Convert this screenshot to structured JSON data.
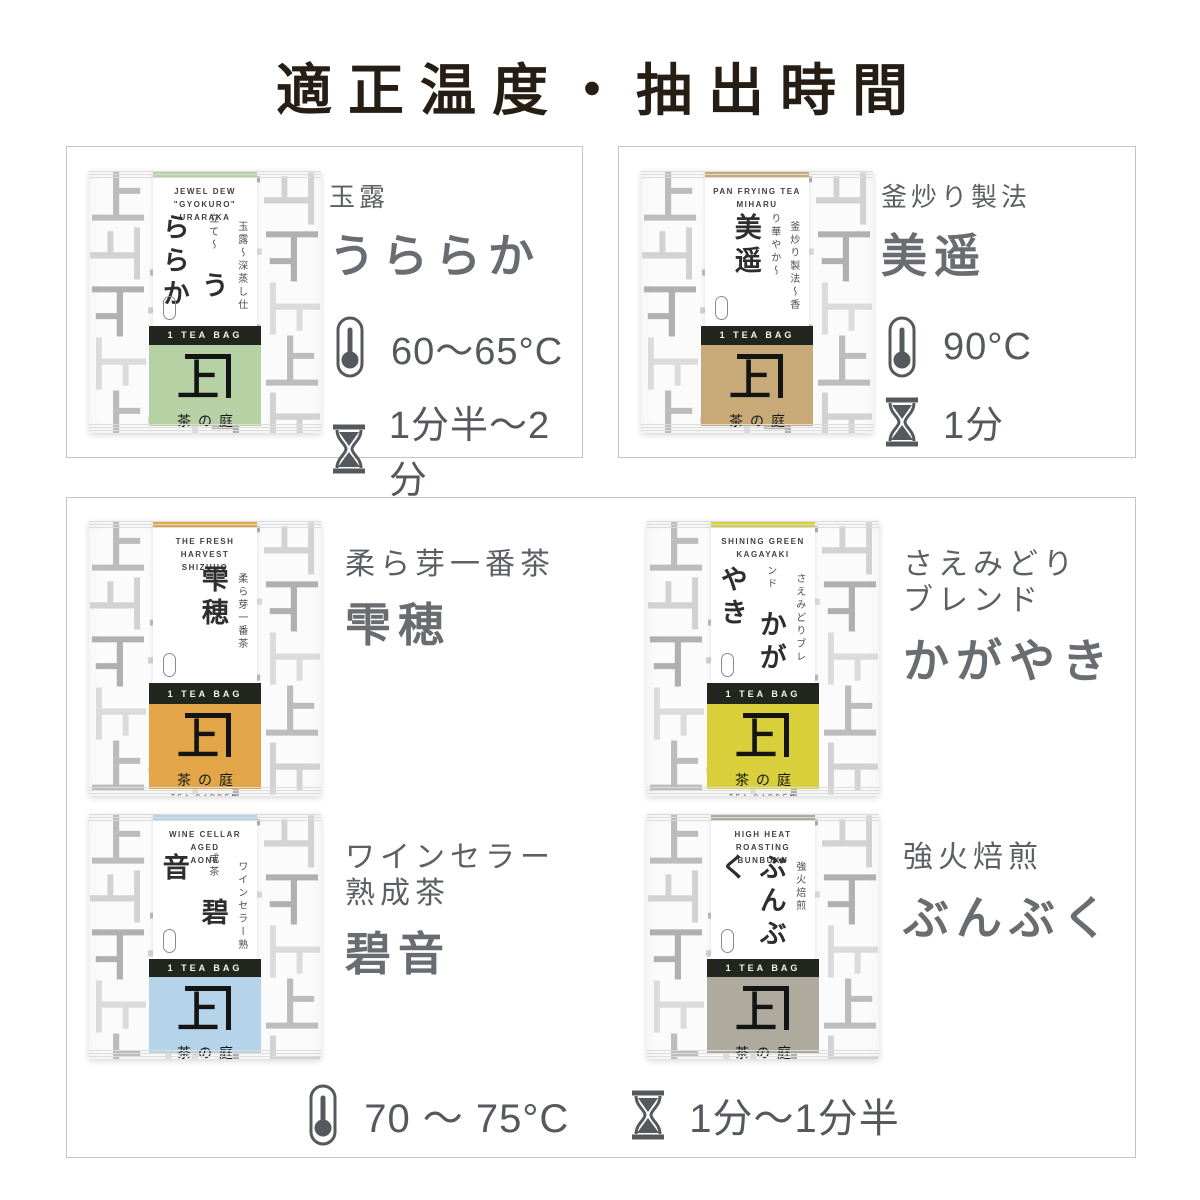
{
  "title": "適正温度・抽出時間",
  "package_common": {
    "tea_bag_label": "1 TEA BAG",
    "logo_kanji": "上",
    "logo_name": "茶の庭",
    "logo_sub": "TEA GARDEN",
    "pattern_char": "上"
  },
  "cards": [
    {
      "id": "uraraka",
      "label": "玉露",
      "name": "うららか",
      "temperature": "60〜65°C",
      "time": "1分半〜2分",
      "package": {
        "english_line1": "JEWEL DEW \"GYOKURO\"",
        "english_line2": "URARAKA",
        "vertical_name": "うららか",
        "vertical_sub": "玉露〜深蒸し仕立て〜",
        "accent": "#b6d1a3"
      }
    },
    {
      "id": "miharu",
      "label": "釜炒り製法",
      "name": "美遥",
      "temperature": "90°C",
      "time": "1分",
      "package": {
        "english_line1": "PAN FRYING TEA",
        "english_line2": "MIHARU",
        "vertical_name": "美遥",
        "vertical_sub": "釜炒り製法〜香り華やか〜",
        "accent": "#c8aa79"
      }
    },
    {
      "id": "shizuho",
      "label": "柔ら芽一番茶",
      "name": "雫穂",
      "package": {
        "english_line1": "THE FRESH HARVEST",
        "english_line2": "SHIZUHO",
        "vertical_name": "雫穂",
        "vertical_sub": "柔ら芽一番茶",
        "accent": "#e2a648"
      }
    },
    {
      "id": "kagayaki",
      "label": "さえみどり\nブレンド",
      "name": "かがやき",
      "package": {
        "english_line1": "SHINING GREEN",
        "english_line2": "KAGAYAKI",
        "vertical_name": "かがやき",
        "vertical_sub": "さえみどりブレンド",
        "accent": "#d8cf3a"
      }
    },
    {
      "id": "aone",
      "label": "ワインセラー\n熟成茶",
      "name": "碧音",
      "package": {
        "english_line1": "WINE CELLAR AGED",
        "english_line2": "AONE",
        "vertical_name": "碧音",
        "vertical_sub": "ワインセラー熟成茶",
        "accent": "#b5d4e9"
      }
    },
    {
      "id": "bunbuku",
      "label": "強火焙煎",
      "name": "ぶんぶく",
      "package": {
        "english_line1": "HIGH HEAT ROASTING",
        "english_line2": "BUNBUKU",
        "vertical_name": "ぶんぶく",
        "vertical_sub": "強火焙煎",
        "accent": "#aeab9e"
      }
    }
  ],
  "shared_spec": {
    "temperature": "70 〜 75°C",
    "time": "1分〜1分半"
  },
  "colors": {
    "title_text": "#261d14",
    "info_text": "#696c70",
    "spec_text": "#55585c",
    "box_border": "#c5c5c5",
    "teabag_bar": "#23261f"
  }
}
